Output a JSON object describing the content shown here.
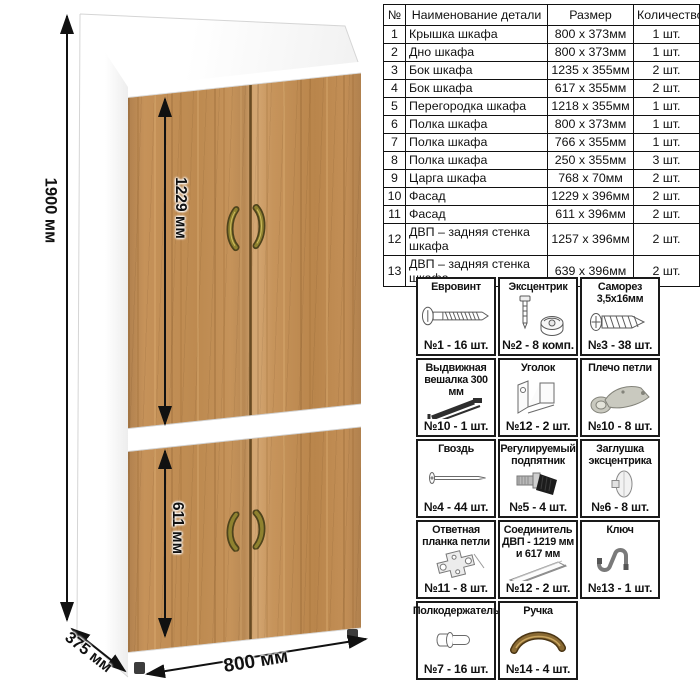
{
  "drawing": {
    "dimensions": {
      "height_label": "1900 мм",
      "upper_section_label": "1229 мм",
      "lower_section_label": "611 мм",
      "width_label": "800 мм",
      "depth_label": "375 мм"
    },
    "colors": {
      "wood": "#c5925a",
      "carcass": "#ffffff",
      "handle_bronze": "#8a6a33",
      "dimension_lines": "#111111"
    }
  },
  "parts_table": {
    "headers": [
      "№",
      "Наименование детали",
      "Размер",
      "Количество"
    ],
    "rows": [
      [
        "1",
        "Крышка шкафа",
        "800 х 373мм",
        "1 шт."
      ],
      [
        "2",
        "Дно шкафа",
        "800 х 373мм",
        "1 шт."
      ],
      [
        "3",
        "Бок шкафа",
        "1235 х 355мм",
        "2 шт."
      ],
      [
        "4",
        "Бок шкафа",
        "617 х 355мм",
        "2 шт."
      ],
      [
        "5",
        "Перегородка шкафа",
        "1218 х 355мм",
        "1 шт."
      ],
      [
        "6",
        "Полка шкафа",
        "800 х 373мм",
        "1 шт."
      ],
      [
        "7",
        "Полка шкафа",
        "766 х 355мм",
        "1 шт."
      ],
      [
        "8",
        "Полка шкафа",
        "250 х 355мм",
        "3 шт."
      ],
      [
        "9",
        "Царга шкафа",
        "768 х 70мм",
        "2 шт."
      ],
      [
        "10",
        "Фасад",
        "1229 х 396мм",
        "2 шт."
      ],
      [
        "11",
        "Фасад",
        "611 х 396мм",
        "2 шт."
      ],
      [
        "12",
        "ДВП – задняя стенка шкафа",
        "1257 х 396мм",
        "2 шт."
      ],
      [
        "13",
        "ДВП – задняя стенка шкафа",
        "639 х 396мм",
        "2 шт."
      ]
    ]
  },
  "hardware": {
    "items": [
      {
        "name": "Евровинт",
        "icon": "eurovint-icon",
        "count": "№1 - 16 шт."
      },
      {
        "name": "Эксцентрик",
        "icon": "eccentric-cam-icon",
        "count": "№2 - 8 комп."
      },
      {
        "name": "Саморез 3,5х16мм",
        "icon": "screw-icon",
        "count": "№3 - 38 шт."
      },
      {
        "name": "Выдвижная вешалка 300 мм",
        "icon": "pullout-hanger-icon",
        "count": "№10 - 1 шт."
      },
      {
        "name": "Уголок",
        "icon": "corner-bracket-icon",
        "count": "№12 - 2 шт."
      },
      {
        "name": "Плечо петли",
        "icon": "hinge-arm-icon",
        "count": "№10 - 8 шт."
      },
      {
        "name": "Гвоздь",
        "icon": "nail-icon",
        "count": "№4 - 44 шт."
      },
      {
        "name": "Регулируемый подпятник",
        "icon": "adjustable-foot-icon",
        "count": "№5 - 4 шт."
      },
      {
        "name": "Заглушка эксцентрика",
        "icon": "cam-cover-icon",
        "count": "№6 - 8 шт."
      },
      {
        "name": "Ответная планка петли",
        "icon": "hinge-plate-icon",
        "count": "№11 - 8 шт."
      },
      {
        "name": "Соединитель ДВП - 1219 мм и 617 мм",
        "icon": "hdf-connector-icon",
        "count": "№12 - 2 шт."
      },
      {
        "name": "Ключ",
        "icon": "hex-key-icon",
        "count": "№13 - 1 шт."
      },
      {
        "name": "Полкодержатель",
        "icon": "shelf-pin-icon",
        "count": "№7 - 16 шт."
      },
      {
        "name": "Ручка",
        "icon": "door-handle-icon",
        "count": "№14 - 4 шт."
      }
    ]
  }
}
